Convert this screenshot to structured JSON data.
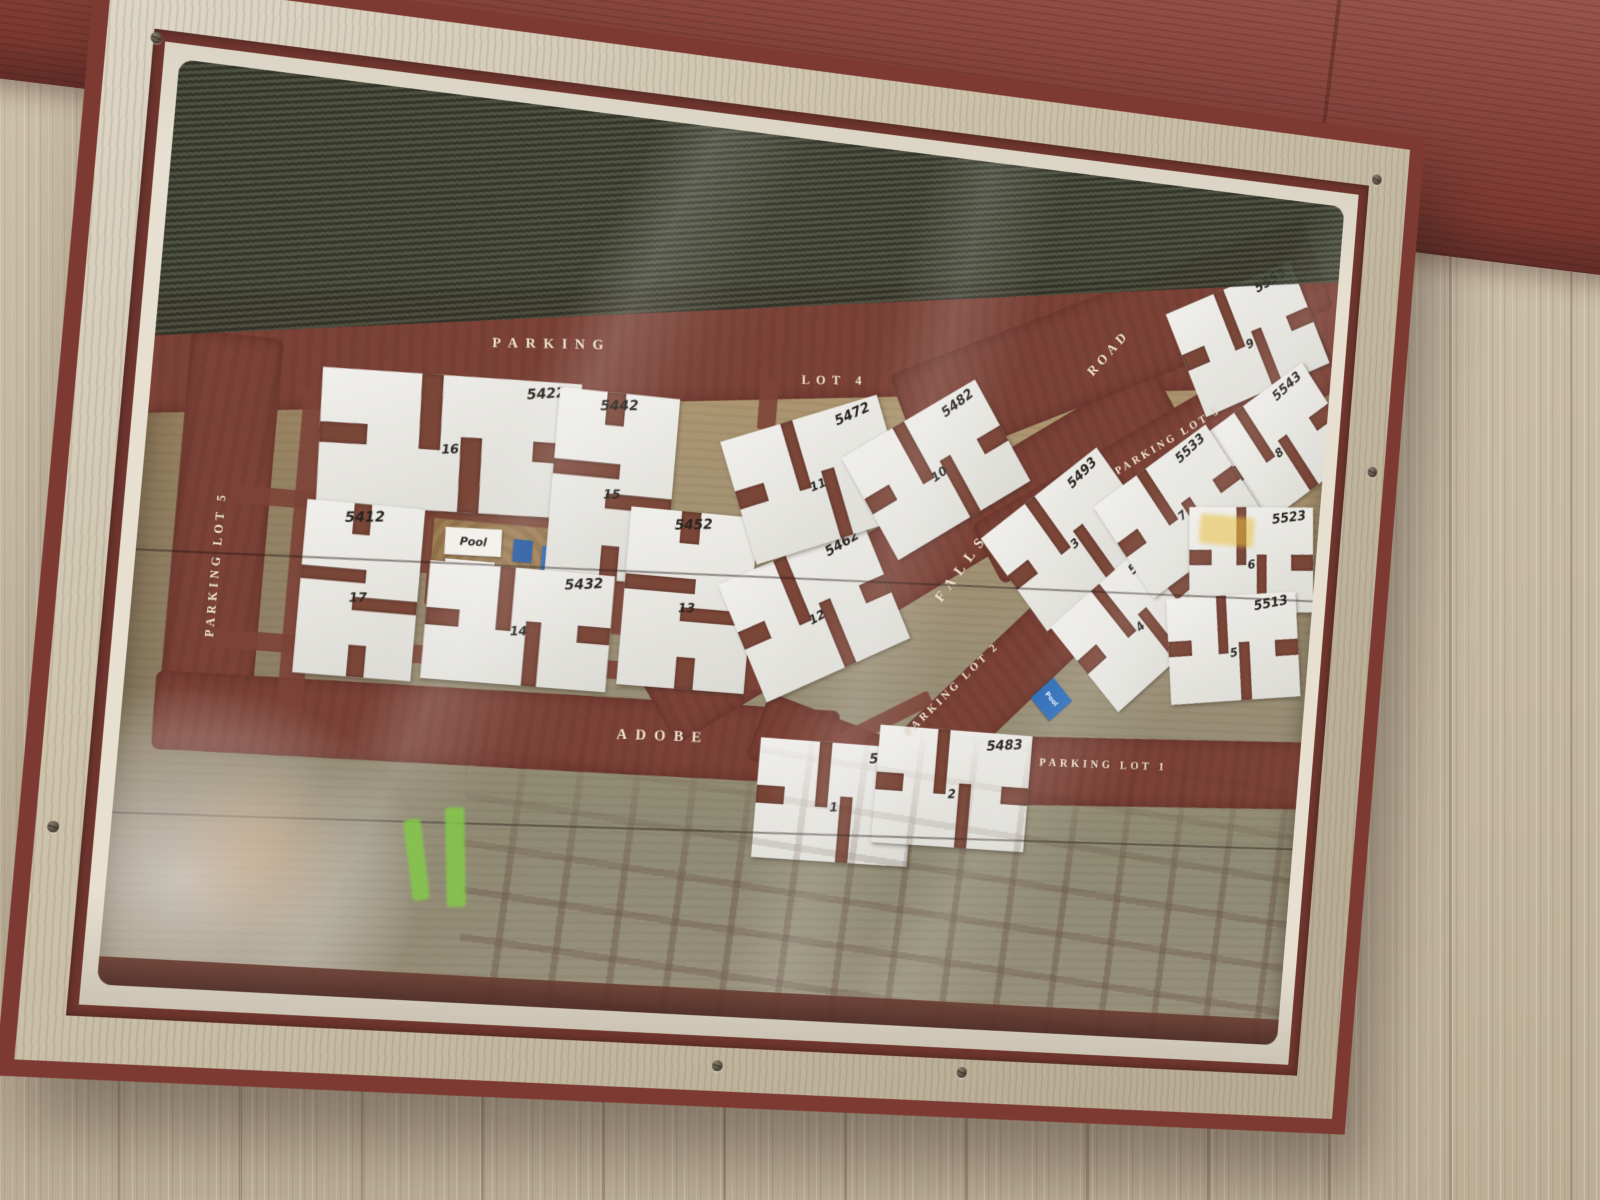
{
  "sign": {
    "map": {
      "title_context": "apartment complex site map",
      "street_labels": [
        {
          "id": "parking",
          "text": "PARKING",
          "x": 31.5,
          "y": 26.5,
          "rot": -5,
          "size": 14,
          "ls": 0.55
        },
        {
          "id": "lot-4",
          "text": "LOT 4",
          "x": 55.5,
          "y": 27.0,
          "rot": -5,
          "size": 13,
          "ls": 0.5
        },
        {
          "id": "road",
          "text": "ROAD",
          "x": 79.5,
          "y": 20.5,
          "rot": -52,
          "size": 14,
          "ls": 0.35
        },
        {
          "id": "parking-lot-3",
          "text": "PARKING LOT 3",
          "x": 85.5,
          "y": 30.0,
          "rot": -35,
          "size": 11.5,
          "ls": 0.3
        },
        {
          "id": "falls",
          "text": "FALLS",
          "x": 68.0,
          "y": 47.0,
          "rot": -58,
          "size": 15,
          "ls": 0.5
        },
        {
          "id": "parking-lot-2",
          "text": "PARKING LOT 2",
          "x": 68.0,
          "y": 61.0,
          "rot": -48,
          "size": 11.5,
          "ls": 0.3
        },
        {
          "id": "parking-lot-1",
          "text": "PARKING LOT 1",
          "x": 82.0,
          "y": 68.5,
          "rot": -2,
          "size": 11.5,
          "ls": 0.35
        },
        {
          "id": "adobe",
          "text": "ADOBE",
          "x": 43.5,
          "y": 69.0,
          "rot": -2,
          "size": 15,
          "ls": 0.55
        },
        {
          "id": "parking-lot-5",
          "text": "PARKING LOT 5",
          "x": 6.3,
          "y": 54.0,
          "rot": -90,
          "size": 11.5,
          "ls": 0.35
        }
      ],
      "roads": [
        {
          "id": "road-top",
          "x": 50,
          "y": 23.5,
          "w": 106,
          "h": 13,
          "rot": -7
        },
        {
          "id": "road-left",
          "x": 6.4,
          "y": 51,
          "w": 7.2,
          "h": 44,
          "rot": 0
        },
        {
          "id": "road-adobe",
          "x": 30.5,
          "y": 69.5,
          "w": 56,
          "h": 8.5,
          "rot": -1
        },
        {
          "id": "road-adobe-curve",
          "x": 62,
          "y": 71,
          "w": 22,
          "h": 8,
          "rot": 16
        },
        {
          "id": "road-falls",
          "x": 64,
          "y": 45.5,
          "w": 52,
          "h": 9.5,
          "rot": -35
        },
        {
          "id": "road-northeast",
          "x": 80,
          "y": 19,
          "w": 40,
          "h": 11.5,
          "rot": -26
        },
        {
          "id": "parking-lot-3",
          "x": 85,
          "y": 31.5,
          "w": 36,
          "h": 8,
          "rot": -34
        },
        {
          "id": "parking-lot-2",
          "x": 70,
          "y": 63,
          "w": 22,
          "h": 8,
          "rot": -47
        },
        {
          "id": "parking-lot-1",
          "x": 86,
          "y": 69,
          "w": 30,
          "h": 8,
          "rot": -3
        }
      ],
      "lanes": [
        {
          "x": 28,
          "y": 46.2,
          "w": 42,
          "h": 2,
          "rot": 0
        },
        {
          "x": 29,
          "y": 62,
          "w": 46,
          "h": 2,
          "rot": 0
        },
        {
          "x": 13,
          "y": 52,
          "w": 2,
          "h": 36,
          "rot": 0
        },
        {
          "x": 22.5,
          "y": 49,
          "w": 1.8,
          "h": 8,
          "rot": 0
        },
        {
          "x": 38.5,
          "y": 53,
          "w": 1.8,
          "h": 10,
          "rot": 0
        },
        {
          "x": 49.9,
          "y": 44,
          "w": 1.6,
          "h": 8,
          "rot": 0
        },
        {
          "x": 50,
          "y": 30.5,
          "w": 1.6,
          "h": 6,
          "rot": 0
        },
        {
          "x": 24.5,
          "y": 33.5,
          "w": 1.6,
          "h": 6,
          "rot": 0
        },
        {
          "x": 60,
          "y": 67,
          "w": 14,
          "h": 1.8,
          "rot": -30
        }
      ],
      "buildings": [
        {
          "num": "16",
          "addr": "5422",
          "x": 24,
          "y": 38.5,
          "w": 21,
          "h": 15,
          "rot": -2,
          "o": "h"
        },
        {
          "num": "15",
          "addr": "5442",
          "x": 37.5,
          "y": 41.5,
          "w": 10,
          "h": 21,
          "rot": 0,
          "o": "v"
        },
        {
          "num": "17",
          "addr": "5412",
          "x": 17.7,
          "y": 55.5,
          "w": 9.5,
          "h": 19,
          "rot": 0,
          "o": "v"
        },
        {
          "num": "14",
          "addr": "5432",
          "x": 30.8,
          "y": 58,
          "w": 15.2,
          "h": 13,
          "rot": 0,
          "o": "h"
        },
        {
          "num": "13",
          "addr": "5452",
          "x": 44.6,
          "y": 53.5,
          "w": 10.7,
          "h": 20,
          "rot": 0,
          "o": "v"
        },
        {
          "num": "12",
          "addr": "5462",
          "x": 55.5,
          "y": 53.5,
          "w": 13.5,
          "h": 14.5,
          "rot": -28,
          "o": "h"
        },
        {
          "num": "11",
          "addr": "5472",
          "x": 54.7,
          "y": 38.5,
          "w": 14,
          "h": 14.5,
          "rot": -22,
          "o": "h"
        },
        {
          "num": "10",
          "addr": "5482",
          "x": 65,
          "y": 36,
          "w": 13.5,
          "h": 13.5,
          "rot": -35,
          "o": "h"
        },
        {
          "num": "3",
          "addr": "5493",
          "x": 77.5,
          "y": 42.5,
          "w": 13,
          "h": 13.5,
          "rot": -42,
          "o": "h"
        },
        {
          "num": "4",
          "addr": "5503",
          "x": 84,
          "y": 51.5,
          "w": 12.5,
          "h": 13,
          "rot": -45,
          "o": "h"
        },
        {
          "num": "9",
          "addr": "5553",
          "x": 92,
          "y": 17,
          "w": 12.5,
          "h": 13,
          "rot": -28,
          "o": "h"
        },
        {
          "num": "8",
          "addr": "5543",
          "x": 95.5,
          "y": 29.5,
          "w": 12.5,
          "h": 13,
          "rot": -40,
          "o": "h"
        },
        {
          "num": "7",
          "addr": "5533",
          "x": 87,
          "y": 38,
          "w": 12.5,
          "h": 13,
          "rot": -40,
          "o": "h"
        },
        {
          "num": "6",
          "addr": "5523",
          "x": 94,
          "y": 43,
          "w": 11.5,
          "h": 12.5,
          "rot": -5,
          "o": "h"
        },
        {
          "num": "5",
          "addr": "5513",
          "x": 93,
          "y": 53.5,
          "w": 12,
          "h": 12.5,
          "rot": -8,
          "o": "h"
        },
        {
          "num": "1",
          "addr": "5473",
          "x": 58.5,
          "y": 75,
          "w": 13.5,
          "h": 13.5,
          "rot": 0,
          "o": "h"
        },
        {
          "num": "2",
          "addr": "5483",
          "x": 68.7,
          "y": 72.5,
          "w": 13.5,
          "h": 13.5,
          "rot": 0,
          "o": "h"
        }
      ],
      "pool": {
        "court": {
          "x": 28.5,
          "y": 51.5,
          "w": 11,
          "h": 10
        },
        "card_label": "Pool",
        "blue_sign_label": "Pool",
        "diamond_label": "Pool"
      }
    },
    "frame": {
      "screws": [
        {
          "x": 3,
          "y": 4.5
        },
        {
          "x": 97,
          "y": 3
        },
        {
          "x": 0.8,
          "y": 78
        },
        {
          "x": 50,
          "y": 97
        },
        {
          "x": 69,
          "y": 96.5
        },
        {
          "x": 98.6,
          "y": 33
        }
      ]
    }
  },
  "colors": {
    "road": "#7c4237",
    "building": "#eceae4",
    "frame_wood": "#ccc2ab",
    "frame_trim": "#6f362e",
    "outer_trim": "#7d3a33",
    "mat": "#e7e0d0",
    "fascia": "#8c4037",
    "siding": "#c6b9a2",
    "pool_blue": "#2e6db8",
    "street_text": "#f1e6d2",
    "map_wood": "#a3906c",
    "glass_reflection": "#3f4434",
    "sky": "#9ccae6"
  }
}
